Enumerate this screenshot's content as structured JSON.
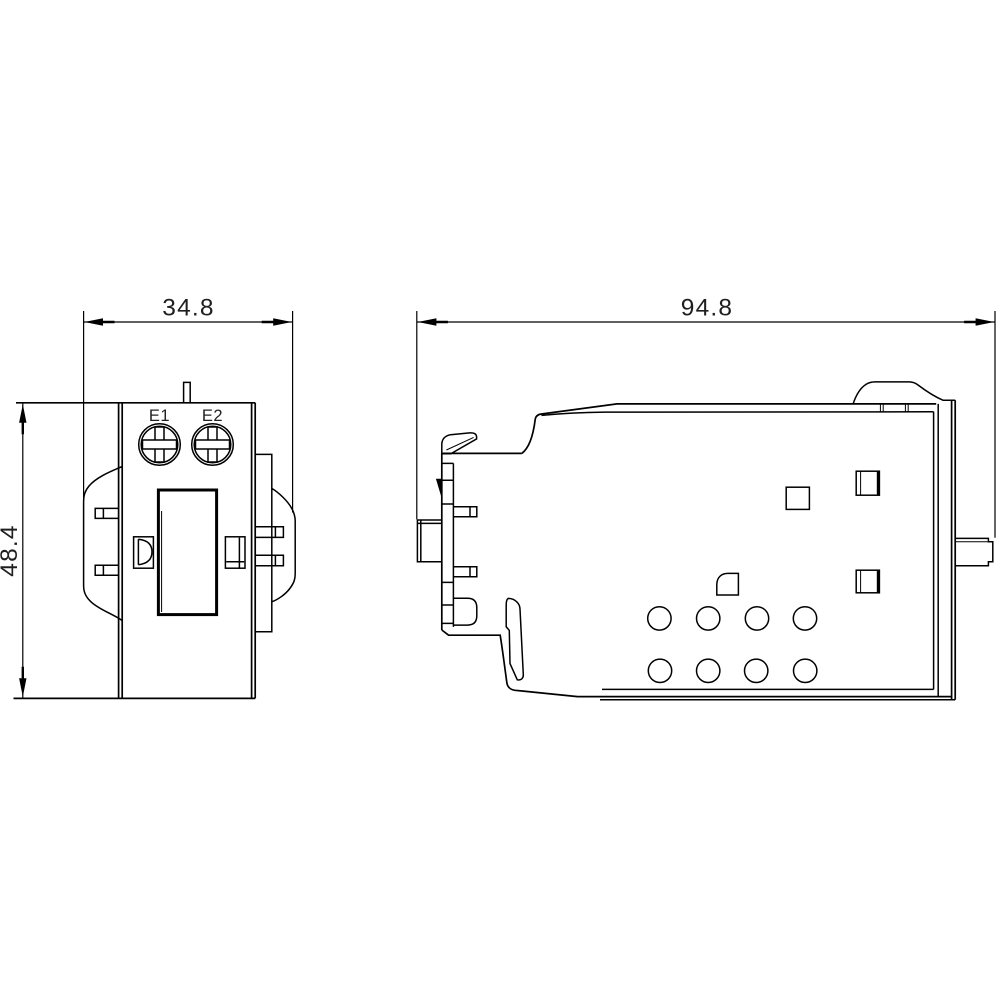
{
  "front_view": {
    "terminal_labels": [
      "E1",
      "E2"
    ],
    "width_dim": "34.8",
    "height_dim": "48.4"
  },
  "side_view": {
    "width_dim": "94.8"
  },
  "colors": {
    "background": "#ffffff",
    "line": "#000000",
    "text": "#1f1f1f"
  }
}
